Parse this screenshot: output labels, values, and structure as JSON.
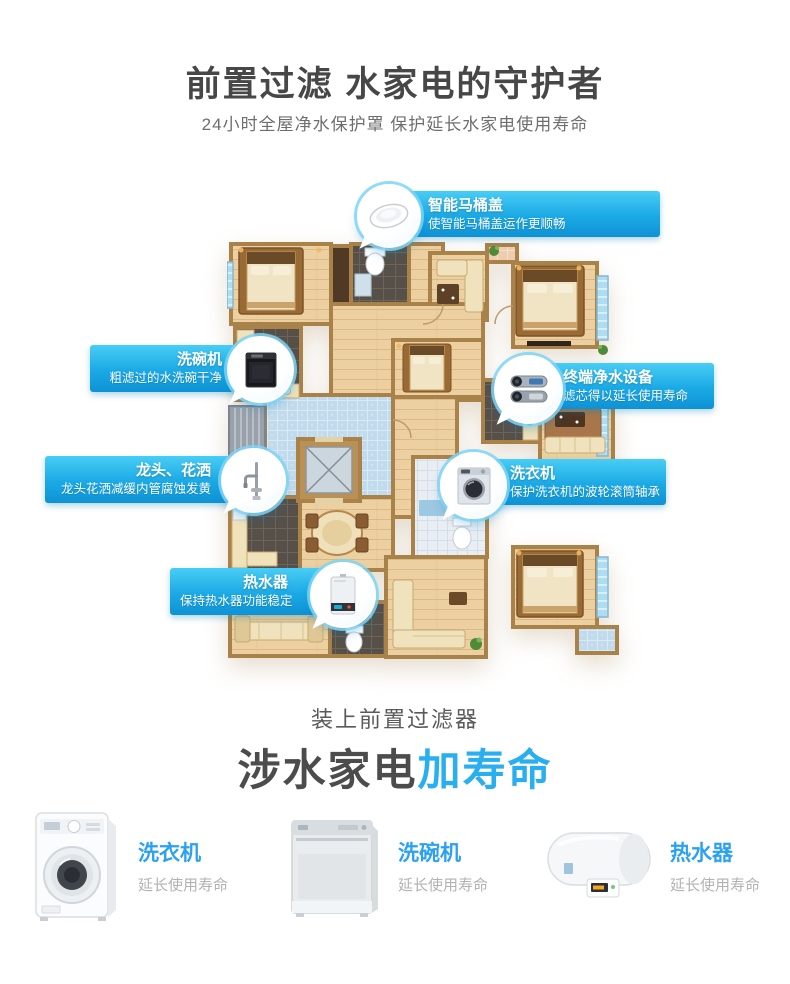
{
  "header": {
    "title": "前置过滤 水家电的守护者",
    "subtitle": "24小时全屋净水保护罩 保护延长水家电使用寿命"
  },
  "floorplan": {
    "callouts": [
      {
        "title": "智能马桶盖",
        "desc": "使智能马桶盖运作更顺畅",
        "icon": "smart-toilet-lid"
      },
      {
        "title": "洗碗机",
        "desc": "粗滤过的水洗碗干净",
        "icon": "dishwasher"
      },
      {
        "title": "终端净水设备",
        "desc": "滤芯得以延长使用寿命",
        "icon": "water-purifier"
      },
      {
        "title": "龙头、花洒",
        "desc": "龙头花洒减缓内管腐蚀发黄",
        "icon": "faucet-shower"
      },
      {
        "title": "洗衣机",
        "desc": "保护洗衣机的波轮滚筒轴承",
        "icon": "washing-machine"
      },
      {
        "title": "热水器",
        "desc": "保持热水器功能稳定",
        "icon": "water-heater"
      }
    ]
  },
  "footer": {
    "lead": "装上前置过滤器",
    "headline_main": "涉水家电",
    "headline_accent": "加寿命",
    "products": [
      {
        "name": "洗衣机",
        "desc": "延长使用寿命",
        "icon": "washing-machine"
      },
      {
        "name": "洗碗机",
        "desc": "延长使用寿命",
        "icon": "dishwasher"
      },
      {
        "name": "热水器",
        "desc": "延长使用寿命",
        "icon": "water-heater"
      }
    ]
  },
  "colors": {
    "callout_gradient_top": "#48cdf5",
    "callout_gradient_bottom": "#0e92d5",
    "accent_blue": "#2ba1f2",
    "headline_accent_blue": "#29aef0",
    "headline_gray": "#4c4c4c",
    "muted_gray": "#b2b2b2"
  }
}
